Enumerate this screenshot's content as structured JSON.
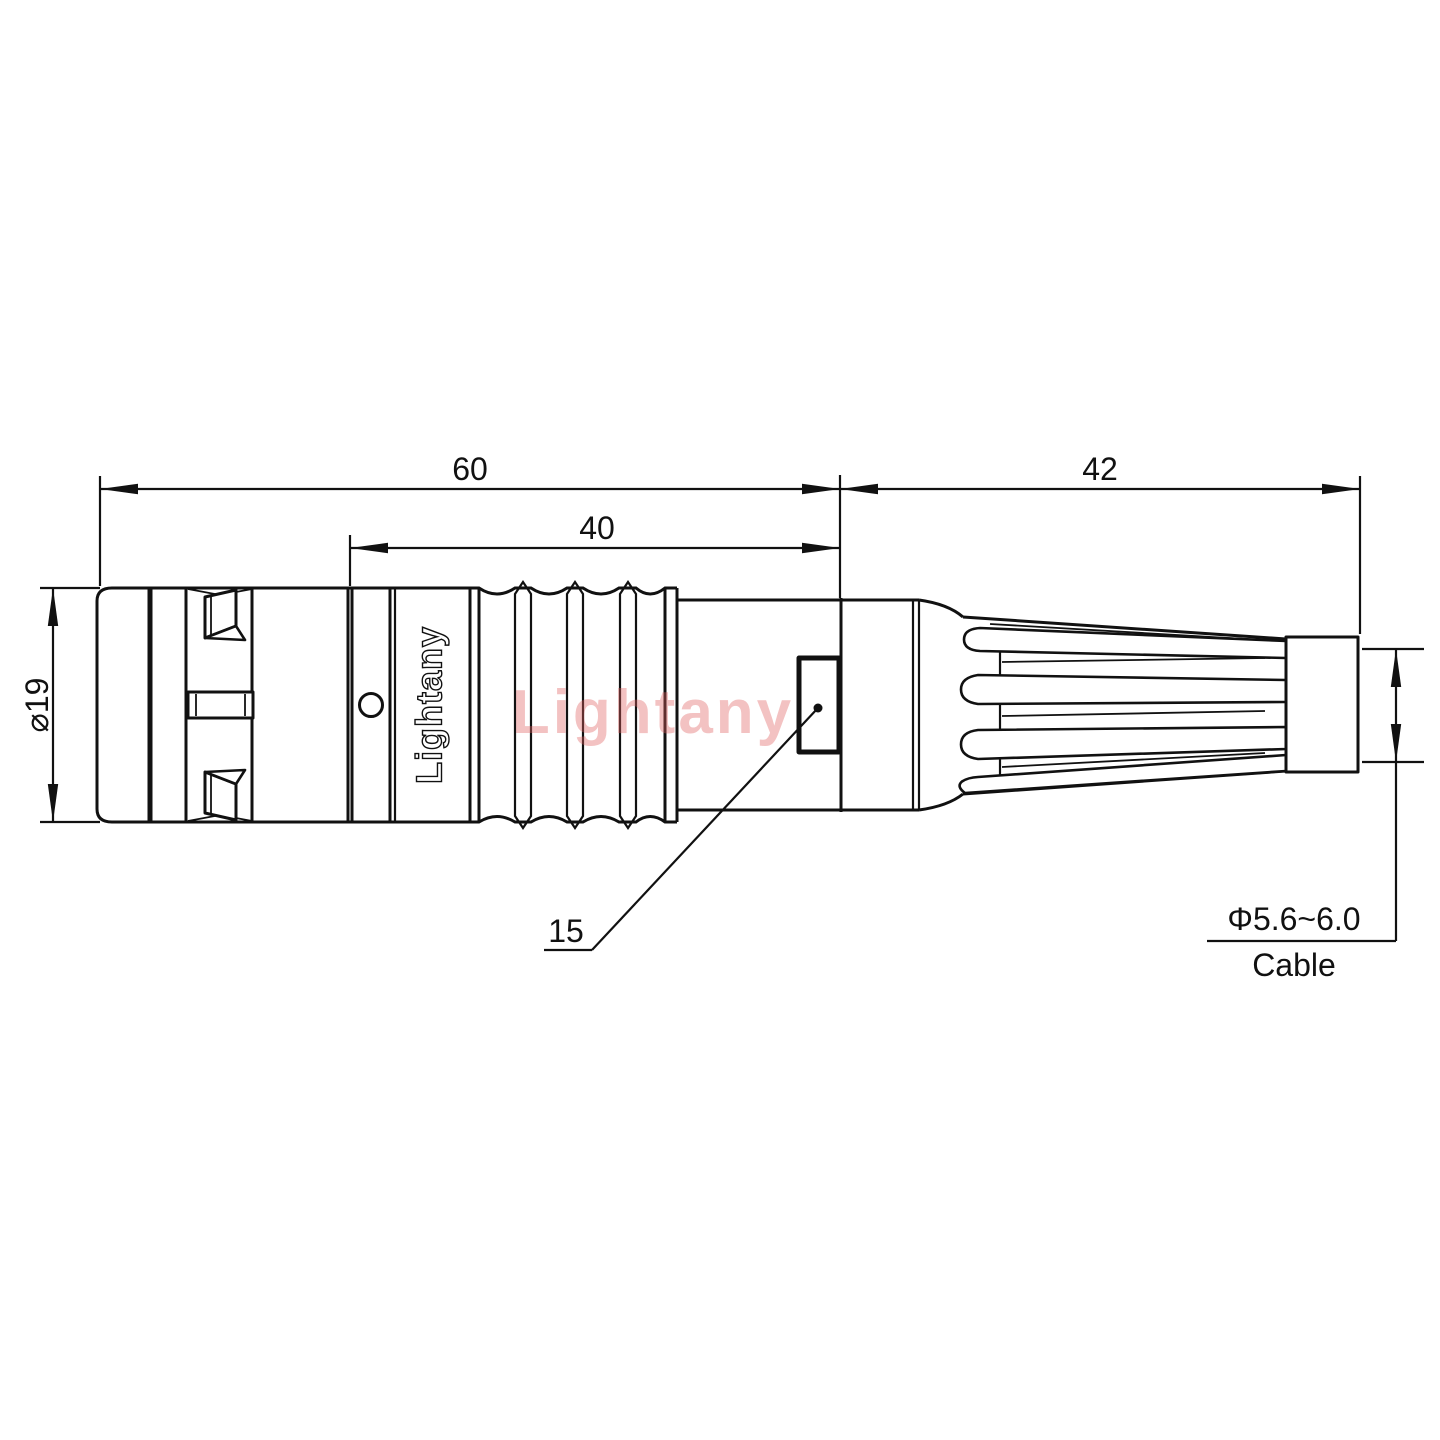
{
  "drawing": {
    "part_labels": {
      "engraved_brand": "Lightany",
      "watermark": "Lightany"
    },
    "dimensions": {
      "overall_length": "60",
      "grip_length": "40",
      "boot_length": "42",
      "body_diameter": "⌀19",
      "slot_callout": "15",
      "cable_diameter_range": "Φ5.6~6.0",
      "cable_label": "Cable"
    },
    "colors": {
      "line": "#111111",
      "watermark_red": "#e06060",
      "background": "#ffffff"
    }
  }
}
